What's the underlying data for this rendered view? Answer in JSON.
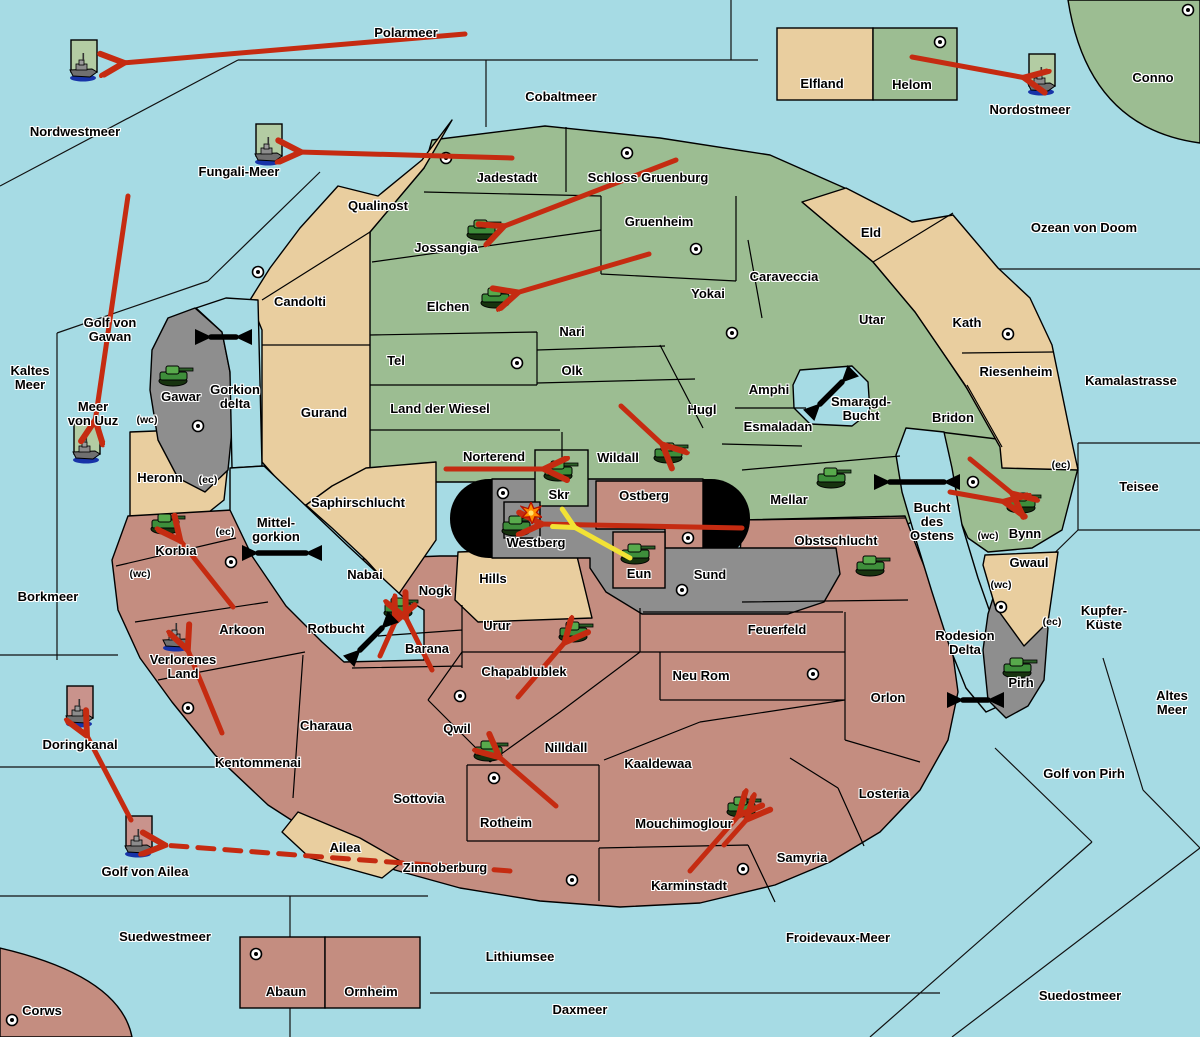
{
  "map": {
    "colors": {
      "sea": "#A6DBE4",
      "land_green": "#9CBD92",
      "land_tan": "#E9CE9F",
      "land_red": "#C48D80",
      "land_gray": "#8E8E8E",
      "black_zone": "#000000",
      "arrow_red": "#C52B11",
      "arrow_yellow": "#F2E235",
      "arrow_black": "#000000",
      "unit_tile_green": "#B3CCA3",
      "unit_tile_red": "#C9938C"
    },
    "labels": [
      {
        "text": "Polarmeer",
        "x": 406,
        "y": 33,
        "kind": "sea"
      },
      {
        "text": "Nordwestmeer",
        "x": 75,
        "y": 132,
        "kind": "sea"
      },
      {
        "text": "Cobaltmeer",
        "x": 561,
        "y": 97,
        "kind": "sea"
      },
      {
        "text": "Nordostmeer",
        "x": 1030,
        "y": 110,
        "kind": "sea"
      },
      {
        "text": "Fungali-Meer",
        "x": 239,
        "y": 172,
        "kind": "sea"
      },
      {
        "text": "Ozean von Doom",
        "x": 1084,
        "y": 228,
        "kind": "sea"
      },
      {
        "text": "Kamalastrasse",
        "x": 1131,
        "y": 381,
        "kind": "sea"
      },
      {
        "text": "Golf von\nGawan",
        "x": 110,
        "y": 330,
        "kind": "sea"
      },
      {
        "text": "Kaltes\nMeer",
        "x": 30,
        "y": 378,
        "kind": "sea"
      },
      {
        "text": "Meer\nvon Uuz",
        "x": 93,
        "y": 414,
        "kind": "sea"
      },
      {
        "text": "Gorkion\ndelta",
        "x": 235,
        "y": 397,
        "kind": "sea"
      },
      {
        "text": "Smaragd-\nBucht",
        "x": 861,
        "y": 409,
        "kind": "sea"
      },
      {
        "text": "Mittel-\ngorkion",
        "x": 276,
        "y": 530,
        "kind": "sea"
      },
      {
        "text": "Borkmeer",
        "x": 48,
        "y": 597,
        "kind": "sea"
      },
      {
        "text": "Rotbucht",
        "x": 336,
        "y": 629,
        "kind": "sea"
      },
      {
        "text": "Doringkanal",
        "x": 80,
        "y": 745,
        "kind": "sea"
      },
      {
        "text": "Golf von Ailea",
        "x": 145,
        "y": 872,
        "kind": "sea"
      },
      {
        "text": "Suedwestmeer",
        "x": 165,
        "y": 937,
        "kind": "sea"
      },
      {
        "text": "Lithiumsee",
        "x": 520,
        "y": 957,
        "kind": "sea"
      },
      {
        "text": "Daxmeer",
        "x": 580,
        "y": 1010,
        "kind": "sea"
      },
      {
        "text": "Froidevaux-Meer",
        "x": 838,
        "y": 938,
        "kind": "sea"
      },
      {
        "text": "Suedostmeer",
        "x": 1080,
        "y": 996,
        "kind": "sea"
      },
      {
        "text": "Golf von Pirh",
        "x": 1084,
        "y": 774,
        "kind": "sea"
      },
      {
        "text": "Altes\nMeer",
        "x": 1172,
        "y": 703,
        "kind": "sea"
      },
      {
        "text": "Teisee",
        "x": 1139,
        "y": 487,
        "kind": "sea"
      },
      {
        "text": "Kupfer-\nKüste",
        "x": 1104,
        "y": 618,
        "kind": "sea"
      },
      {
        "text": "Bucht\ndes\nOstens",
        "x": 932,
        "y": 522,
        "kind": "sea"
      },
      {
        "text": "Rodesion\nDelta",
        "x": 965,
        "y": 643,
        "kind": "sea"
      },
      {
        "text": "Elfland",
        "x": 822,
        "y": 84,
        "kind": "land"
      },
      {
        "text": "Helom",
        "x": 912,
        "y": 85,
        "kind": "land"
      },
      {
        "text": "Conno",
        "x": 1153,
        "y": 78,
        "kind": "land"
      },
      {
        "text": "Qualinost",
        "x": 378,
        "y": 206,
        "kind": "land"
      },
      {
        "text": "Jadestadt",
        "x": 507,
        "y": 178,
        "kind": "land"
      },
      {
        "text": "Schloss Gruenburg",
        "x": 648,
        "y": 178,
        "kind": "land"
      },
      {
        "text": "Jossangia",
        "x": 446,
        "y": 248,
        "kind": "land"
      },
      {
        "text": "Gruenheim",
        "x": 659,
        "y": 222,
        "kind": "land"
      },
      {
        "text": "Elchen",
        "x": 448,
        "y": 307,
        "kind": "land"
      },
      {
        "text": "Yokai",
        "x": 708,
        "y": 294,
        "kind": "land"
      },
      {
        "text": "Caraveccia",
        "x": 784,
        "y": 277,
        "kind": "land"
      },
      {
        "text": "Eld",
        "x": 871,
        "y": 233,
        "kind": "land"
      },
      {
        "text": "Utar",
        "x": 872,
        "y": 320,
        "kind": "land"
      },
      {
        "text": "Kath",
        "x": 967,
        "y": 323,
        "kind": "land"
      },
      {
        "text": "Riesenheim",
        "x": 1016,
        "y": 372,
        "kind": "land"
      },
      {
        "text": "Bridon",
        "x": 953,
        "y": 418,
        "kind": "land"
      },
      {
        "text": "Nari",
        "x": 572,
        "y": 332,
        "kind": "land"
      },
      {
        "text": "Olk",
        "x": 572,
        "y": 371,
        "kind": "land"
      },
      {
        "text": "Tel",
        "x": 396,
        "y": 361,
        "kind": "land"
      },
      {
        "text": "Land der Wiesel",
        "x": 440,
        "y": 409,
        "kind": "land"
      },
      {
        "text": "Candolti",
        "x": 300,
        "y": 302,
        "kind": "land"
      },
      {
        "text": "Gurand",
        "x": 324,
        "y": 413,
        "kind": "land"
      },
      {
        "text": "Gawar",
        "x": 181,
        "y": 397,
        "kind": "land"
      },
      {
        "text": "Heronn",
        "x": 160,
        "y": 478,
        "kind": "land"
      },
      {
        "text": "Hugl",
        "x": 702,
        "y": 410,
        "kind": "land"
      },
      {
        "text": "Amphi",
        "x": 769,
        "y": 390,
        "kind": "land"
      },
      {
        "text": "Esmaladan",
        "x": 778,
        "y": 427,
        "kind": "land"
      },
      {
        "text": "Norterend",
        "x": 494,
        "y": 457,
        "kind": "land"
      },
      {
        "text": "Wildall",
        "x": 618,
        "y": 458,
        "kind": "land"
      },
      {
        "text": "Skr",
        "x": 559,
        "y": 495,
        "kind": "land"
      },
      {
        "text": "Ostberg",
        "x": 644,
        "y": 496,
        "kind": "land"
      },
      {
        "text": "Mellar",
        "x": 789,
        "y": 500,
        "kind": "land"
      },
      {
        "text": "Westberg",
        "x": 536,
        "y": 543,
        "kind": "land"
      },
      {
        "text": "Eun",
        "x": 639,
        "y": 574,
        "kind": "land"
      },
      {
        "text": "Sund",
        "x": 710,
        "y": 575,
        "kind": "land"
      },
      {
        "text": "Obstschlucht",
        "x": 836,
        "y": 541,
        "kind": "land"
      },
      {
        "text": "Feuerfeld",
        "x": 777,
        "y": 630,
        "kind": "land"
      },
      {
        "text": "Neu Rom",
        "x": 701,
        "y": 676,
        "kind": "land"
      },
      {
        "text": "Orlon",
        "x": 888,
        "y": 698,
        "kind": "land"
      },
      {
        "text": "Saphirschlucht",
        "x": 358,
        "y": 503,
        "kind": "land"
      },
      {
        "text": "Nabai",
        "x": 365,
        "y": 575,
        "kind": "land"
      },
      {
        "text": "Hills",
        "x": 493,
        "y": 579,
        "kind": "land"
      },
      {
        "text": "Korbia",
        "x": 176,
        "y": 551,
        "kind": "land"
      },
      {
        "text": "Arkoon",
        "x": 242,
        "y": 630,
        "kind": "land"
      },
      {
        "text": "Verlorenes\nLand",
        "x": 183,
        "y": 667,
        "kind": "land"
      },
      {
        "text": "Kentommenai",
        "x": 258,
        "y": 763,
        "kind": "land"
      },
      {
        "text": "Charaua",
        "x": 326,
        "y": 726,
        "kind": "land"
      },
      {
        "text": "Nogk",
        "x": 435,
        "y": 591,
        "kind": "land"
      },
      {
        "text": "Barana",
        "x": 427,
        "y": 649,
        "kind": "land"
      },
      {
        "text": "Urur",
        "x": 497,
        "y": 626,
        "kind": "land"
      },
      {
        "text": "Chapablublek",
        "x": 524,
        "y": 672,
        "kind": "land"
      },
      {
        "text": "Qwil",
        "x": 457,
        "y": 729,
        "kind": "land"
      },
      {
        "text": "Nilldall",
        "x": 566,
        "y": 748,
        "kind": "land"
      },
      {
        "text": "Kaaldewaa",
        "x": 658,
        "y": 764,
        "kind": "land"
      },
      {
        "text": "Rotheim",
        "x": 506,
        "y": 823,
        "kind": "land"
      },
      {
        "text": "Sottovia",
        "x": 419,
        "y": 799,
        "kind": "land"
      },
      {
        "text": "Zinnoberburg",
        "x": 445,
        "y": 868,
        "kind": "land"
      },
      {
        "text": "Mouchimoglour",
        "x": 684,
        "y": 824,
        "kind": "land"
      },
      {
        "text": "Karminstadt",
        "x": 689,
        "y": 886,
        "kind": "land"
      },
      {
        "text": "Samyria",
        "x": 802,
        "y": 858,
        "kind": "land"
      },
      {
        "text": "Losteria",
        "x": 884,
        "y": 794,
        "kind": "land"
      },
      {
        "text": "Ailea",
        "x": 345,
        "y": 848,
        "kind": "land"
      },
      {
        "text": "Bynn",
        "x": 1025,
        "y": 534,
        "kind": "land"
      },
      {
        "text": "Gwaul",
        "x": 1029,
        "y": 563,
        "kind": "land"
      },
      {
        "text": "Pirh",
        "x": 1021,
        "y": 683,
        "kind": "land"
      },
      {
        "text": "Abaun",
        "x": 286,
        "y": 992,
        "kind": "land"
      },
      {
        "text": "Ornheim",
        "x": 371,
        "y": 992,
        "kind": "land"
      },
      {
        "text": "Corws",
        "x": 42,
        "y": 1011,
        "kind": "land"
      },
      {
        "text": "(wc)",
        "x": 147,
        "y": 420,
        "kind": "tag"
      },
      {
        "text": "(ec)",
        "x": 208,
        "y": 480,
        "kind": "tag"
      },
      {
        "text": "(ec)",
        "x": 225,
        "y": 532,
        "kind": "tag"
      },
      {
        "text": "(wc)",
        "x": 140,
        "y": 574,
        "kind": "tag"
      },
      {
        "text": "(ec)",
        "x": 1061,
        "y": 465,
        "kind": "tag"
      },
      {
        "text": "(wc)",
        "x": 988,
        "y": 536,
        "kind": "tag"
      },
      {
        "text": "(wc)",
        "x": 1001,
        "y": 585,
        "kind": "tag"
      },
      {
        "text": "(ec)",
        "x": 1052,
        "y": 622,
        "kind": "tag"
      }
    ],
    "cities": [
      [
        940,
        42
      ],
      [
        1188,
        10
      ],
      [
        446,
        158
      ],
      [
        627,
        153
      ],
      [
        696,
        249
      ],
      [
        258,
        272
      ],
      [
        1008,
        334
      ],
      [
        517,
        363
      ],
      [
        732,
        333
      ],
      [
        198,
        426
      ],
      [
        503,
        493
      ],
      [
        973,
        482
      ],
      [
        688,
        538
      ],
      [
        682,
        590
      ],
      [
        231,
        562
      ],
      [
        188,
        708
      ],
      [
        460,
        696
      ],
      [
        494,
        778
      ],
      [
        1001,
        607
      ],
      [
        813,
        674
      ],
      [
        743,
        869
      ],
      [
        572,
        880
      ],
      [
        256,
        954
      ],
      [
        12,
        1020
      ]
    ],
    "tanks": [
      [
        483,
        229
      ],
      [
        497,
        297
      ],
      [
        175,
        375
      ],
      [
        560,
        470
      ],
      [
        670,
        452
      ],
      [
        518,
        525
      ],
      [
        637,
        553
      ],
      [
        833,
        477
      ],
      [
        1023,
        502
      ],
      [
        872,
        565
      ],
      [
        1019,
        667
      ],
      [
        167,
        523
      ],
      [
        400,
        607
      ],
      [
        575,
        631
      ],
      [
        490,
        750
      ],
      [
        743,
        806
      ]
    ],
    "ships": [
      {
        "x": 84,
        "y": 64,
        "tile": "green"
      },
      {
        "x": 269,
        "y": 148,
        "tile": "green"
      },
      {
        "x": 1042,
        "y": 78,
        "tile": "green"
      },
      {
        "x": 87,
        "y": 446,
        "tile": "green"
      },
      {
        "x": 177,
        "y": 634,
        "tile": "none"
      },
      {
        "x": 80,
        "y": 710,
        "tile": "red"
      },
      {
        "x": 139,
        "y": 840,
        "tile": "red"
      }
    ],
    "red_arrows": [
      {
        "x1": 465,
        "y1": 34,
        "x2": 122,
        "y2": 63
      },
      {
        "x1": 912,
        "y1": 57,
        "x2": 1026,
        "y2": 78
      },
      {
        "x1": 512,
        "y1": 158,
        "x2": 299,
        "y2": 152
      },
      {
        "x1": 676,
        "y1": 160,
        "x2": 502,
        "y2": 227
      },
      {
        "x1": 649,
        "y1": 254,
        "x2": 516,
        "y2": 293
      },
      {
        "x1": 621,
        "y1": 406,
        "x2": 664,
        "y2": 446
      },
      {
        "x1": 446,
        "y1": 469,
        "x2": 546,
        "y2": 469
      },
      {
        "x1": 742,
        "y1": 528,
        "x2": 540,
        "y2": 524
      },
      {
        "x1": 970,
        "y1": 459,
        "x2": 1014,
        "y2": 495
      },
      {
        "x1": 950,
        "y1": 492,
        "x2": 1006,
        "y2": 502
      },
      {
        "x1": 233,
        "y1": 607,
        "x2": 179,
        "y2": 539
      },
      {
        "x1": 222,
        "y1": 733,
        "x2": 187,
        "y2": 648
      },
      {
        "x1": 131,
        "y1": 820,
        "x2": 86,
        "y2": 734
      },
      {
        "x1": 510,
        "y1": 871,
        "x2": 163,
        "y2": 845,
        "dashed": true
      },
      {
        "x1": 432,
        "y1": 670,
        "x2": 405,
        "y2": 616
      },
      {
        "x1": 380,
        "y1": 656,
        "x2": 396,
        "y2": 620
      },
      {
        "x1": 518,
        "y1": 697,
        "x2": 566,
        "y2": 641
      },
      {
        "x1": 556,
        "y1": 806,
        "x2": 498,
        "y2": 756
      },
      {
        "x1": 690,
        "y1": 871,
        "x2": 740,
        "y2": 814
      },
      {
        "x1": 724,
        "y1": 845,
        "x2": 748,
        "y2": 818
      },
      {
        "x1": 128,
        "y1": 196,
        "x2": 95,
        "y2": 422
      }
    ],
    "yellow_arrows": [
      {
        "x1": 630,
        "y1": 558,
        "x2": 574,
        "y2": 527
      }
    ],
    "black_arrows": [
      {
        "x1": 211,
        "y1": 337,
        "x2": 236,
        "y2": 337
      },
      {
        "x1": 820,
        "y1": 404,
        "x2": 842,
        "y2": 382
      },
      {
        "x1": 258,
        "y1": 553,
        "x2": 306,
        "y2": 553
      },
      {
        "x1": 360,
        "y1": 650,
        "x2": 382,
        "y2": 628
      },
      {
        "x1": 890,
        "y1": 482,
        "x2": 944,
        "y2": 482
      },
      {
        "x1": 963,
        "y1": 700,
        "x2": 988,
        "y2": 700
      }
    ],
    "explosion": {
      "x": 531,
      "y": 513
    }
  }
}
